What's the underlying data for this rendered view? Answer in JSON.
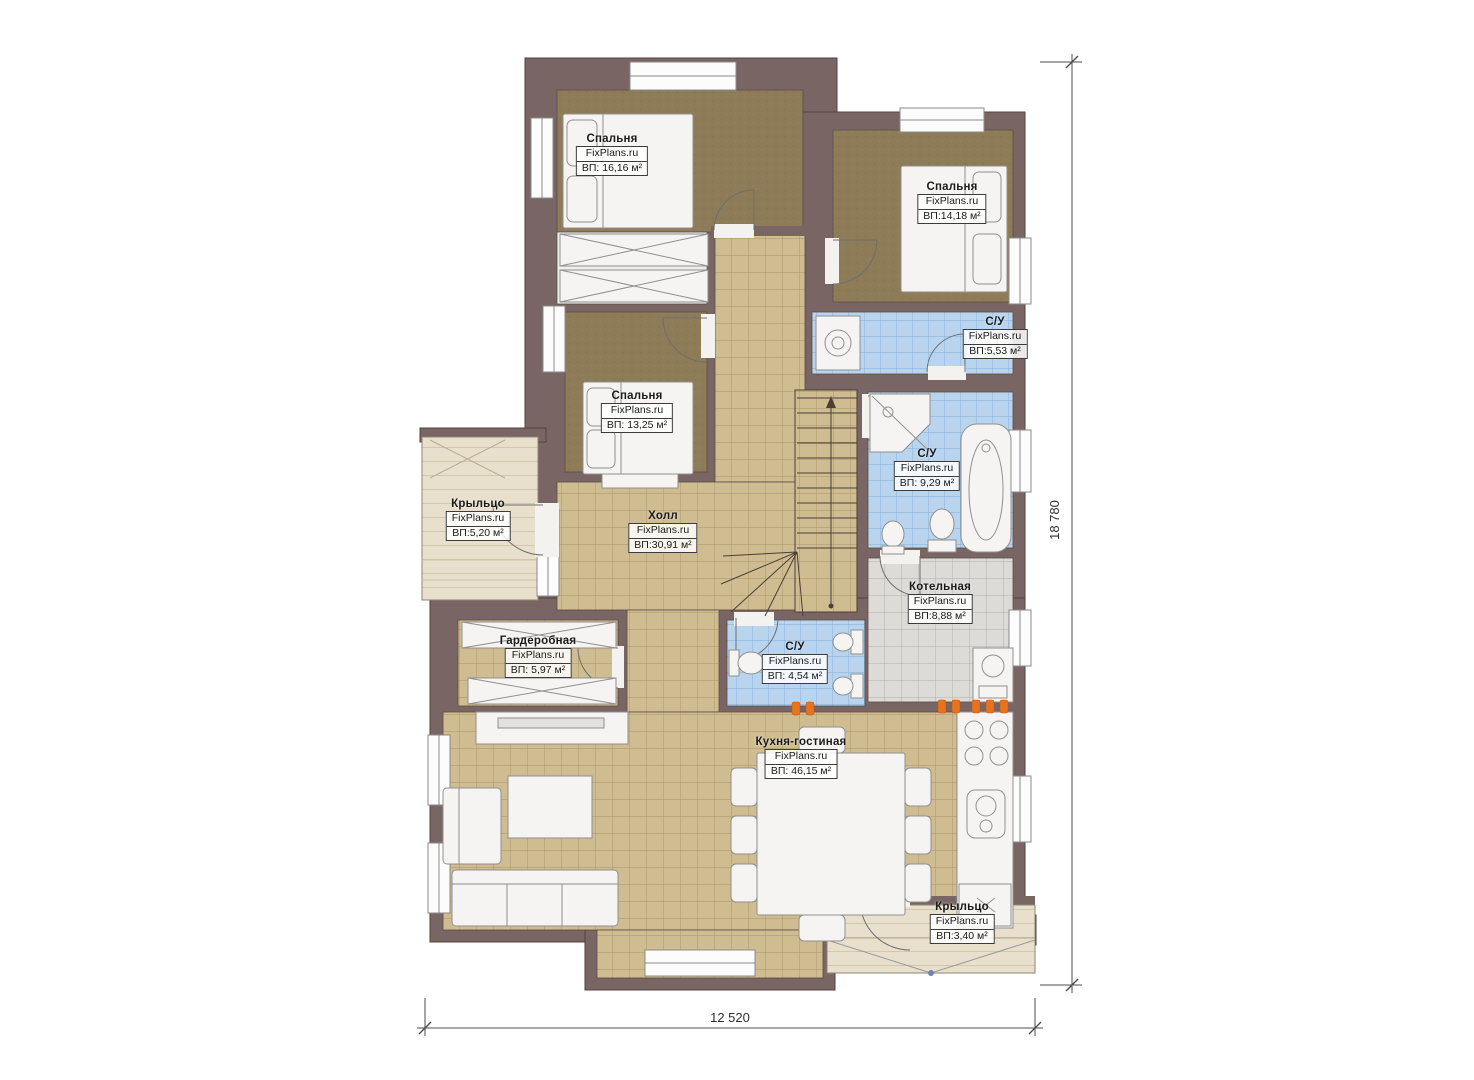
{
  "plan": {
    "brand": "FixPlans.ru",
    "rooms": [
      {
        "id": "bedroom-1",
        "name": "Спальня",
        "area": "ВП: 16,16 м²"
      },
      {
        "id": "bedroom-2",
        "name": "Спальня",
        "area": "ВП:14,18 м²"
      },
      {
        "id": "bathroom-top",
        "name": "С/У",
        "area": "ВП:5,53 м²"
      },
      {
        "id": "bedroom-3",
        "name": "Спальня",
        "area": "ВП: 13,25 м²"
      },
      {
        "id": "bathroom-main",
        "name": "С/У",
        "area": "ВП: 9,29 м²"
      },
      {
        "id": "porch-left",
        "name": "Крыльцо",
        "area": "ВП:5,20 м²"
      },
      {
        "id": "hall",
        "name": "Холл",
        "area": "ВП:30,91 м²"
      },
      {
        "id": "boiler-room",
        "name": "Котельная",
        "area": "ВП:8,88 м²"
      },
      {
        "id": "wardrobe-room",
        "name": "Гардеробная",
        "area": "ВП: 5,97 м²"
      },
      {
        "id": "bathroom-small",
        "name": "С/У",
        "area": "ВП: 4,54 м²"
      },
      {
        "id": "kitchen-living",
        "name": "Кухня-гостиная",
        "area": "ВП: 46,15 м²"
      },
      {
        "id": "porch-bottom",
        "name": "Крыльцо",
        "area": "ВП:3,40 м²"
      }
    ],
    "dimensions": {
      "total_height_mm": "18 780",
      "total_width_mm": "12 520"
    },
    "colors": {
      "wall": "#796664",
      "carpet": "#8d7c57",
      "tile_tan": "#cfbc90",
      "tile_blue": "#b9d4ee",
      "tile_gray": "#dcdbd8",
      "porch": "#e8e0cd",
      "burner_orange": "#e8731e"
    }
  }
}
